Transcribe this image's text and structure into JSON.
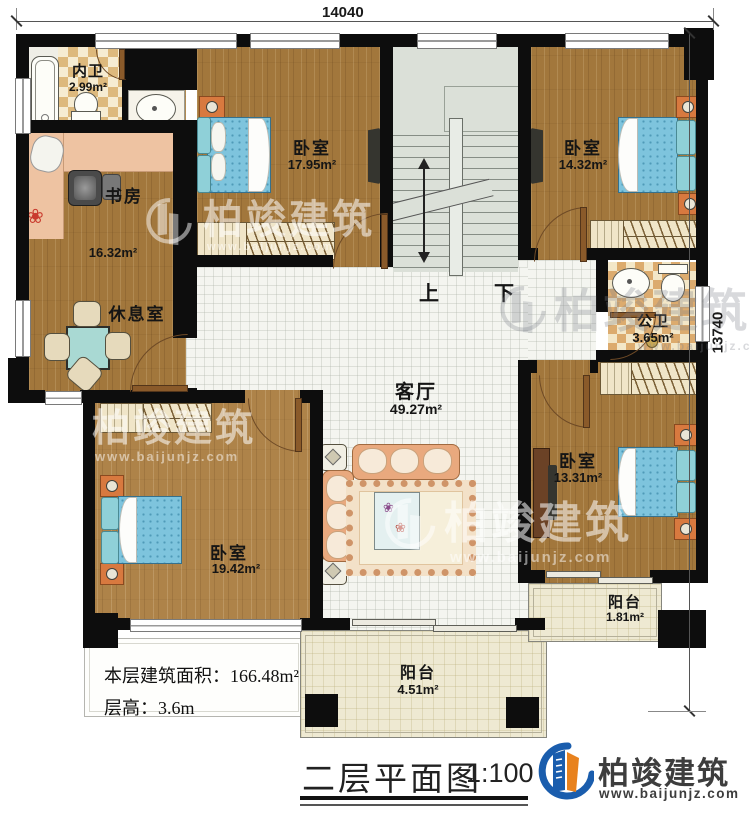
{
  "dimensions": {
    "top": "14040",
    "right": "13740"
  },
  "rooms": {
    "neiwei": {
      "name": "内卫",
      "area": "2.99m²"
    },
    "shufang": {
      "name": "书房",
      "area": "16.32m²"
    },
    "xiuxishi": {
      "name": "休息室"
    },
    "bedroom_top": {
      "name": "卧室",
      "area": "17.95m²"
    },
    "bedroom_topright": {
      "name": "卧室",
      "area": "14.32m²"
    },
    "gongwei": {
      "name": "公卫",
      "area": "3.65m²"
    },
    "keting": {
      "name": "客厅",
      "area": "49.27m²"
    },
    "bedroom_right": {
      "name": "卧室",
      "area": "13.31m²"
    },
    "bedroom_bottomleft": {
      "name": "卧室",
      "area": "19.42m²"
    },
    "balcony_right": {
      "name": "阳台",
      "area": "1.81m²"
    },
    "balcony_bottom": {
      "name": "阳台",
      "area": "4.51m²"
    }
  },
  "stairs": {
    "up_label": "上",
    "down_label": "下"
  },
  "info": {
    "area_line": "本层建筑面积：166.48m²",
    "height_line": "层高：3.6m"
  },
  "titleblock": {
    "title": "二层平面图",
    "scale": "1:100"
  },
  "brand": {
    "name": "柏竣建筑",
    "url": "www.baijunjz.com"
  },
  "watermark": {
    "name": "柏竣建筑",
    "url": "www.baijunjz.com"
  },
  "colors": {
    "wall": "#0d0d0d",
    "wood": "#a2773c",
    "tile": "#f4f5f0",
    "accent_blue": "#1a5dad",
    "accent_orange": "#e8821e"
  }
}
